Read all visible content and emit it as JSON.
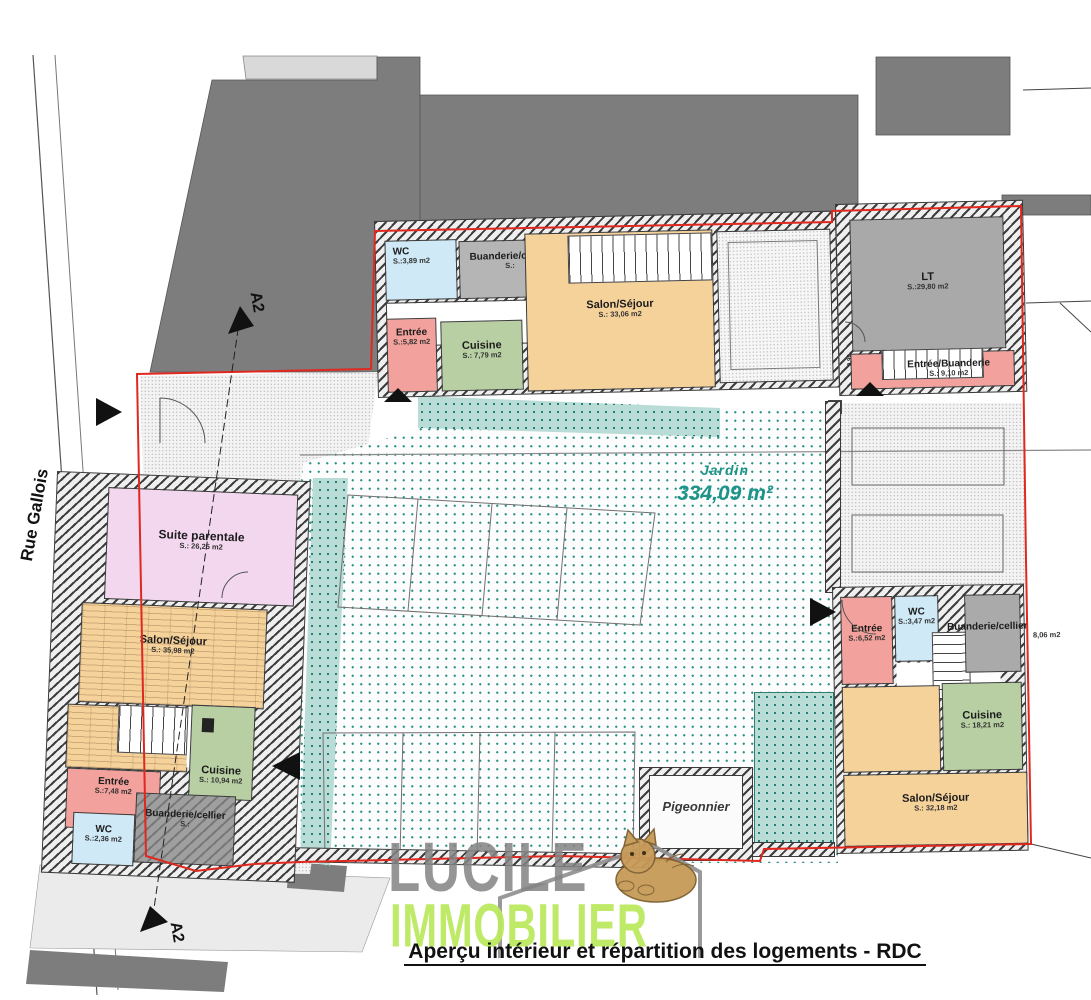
{
  "caption": "Aperçu intérieur et répartition des logements - RDC",
  "street_label": "Rue Gallois",
  "section_marks": {
    "top": "A2",
    "bottom": "A2"
  },
  "garden": {
    "label": "Jardin",
    "area": "334,09 m²"
  },
  "watermark": {
    "line1": "LUCILE",
    "line2": "IMMOBILIER"
  },
  "dimension_small": "0,90",
  "colors": {
    "boundary_red": "#e0281e",
    "garden_teal": "#1d9489",
    "watermark_green": "#bce95f",
    "watermark_gray": "#8e8e8e",
    "entree_pink": "#f2a19c",
    "wc_blue": "#cfe9f6",
    "cuisine_green": "#b7cfa2",
    "salon_orange": "#f6d29b",
    "suite_pink": "#f3d7ef",
    "buanderie_gray": "#b0b0b0"
  },
  "rooms": {
    "u1_wc": {
      "name": "WC",
      "area": "S.:3,89 m2"
    },
    "u1_buanderie": {
      "name": "Buanderie/cellier",
      "area": "S.:"
    },
    "u1_entree": {
      "name": "Entrée",
      "area": "S.:5,82 m2"
    },
    "u1_cuisine": {
      "name": "Cuisine",
      "area": "S.: 7,79 m2"
    },
    "u1_salon": {
      "name": "Salon/Séjour",
      "area": "S.:   33,06 m2"
    },
    "u2_lt": {
      "name": "LT",
      "area": "S.:29,80 m2"
    },
    "u2_entree_buanderie": {
      "name": "Entrée/Buanderie",
      "area": "S.:   9,10 m2"
    },
    "u3_suite": {
      "name": "Suite parentale",
      "area": "S.:   26,25 m2"
    },
    "u3_salon": {
      "name": "Salon/Séjour",
      "area": "S.:   35,98 m2"
    },
    "u3_cuisine": {
      "name": "Cuisine",
      "area": "S.: 10,94 m2"
    },
    "u3_entree": {
      "name": "Entrée",
      "area": "S.:7,48 m2"
    },
    "u3_buanderie": {
      "name": "Buanderie/cellier",
      "area": "S.:"
    },
    "u3_wc": {
      "name": "WC",
      "area": "S.:2,36 m2"
    },
    "u4_entree": {
      "name": "Entrée",
      "area": "S.:6,52 m2"
    },
    "u4_wc": {
      "name": "WC",
      "area": "S.:3,47 m2"
    },
    "u4_buanderie": {
      "name": "Buanderie/cellier",
      "area": "8,06 m2"
    },
    "u4_cuisine": {
      "name": "Cuisine",
      "area": "S.: 18,21 m2"
    },
    "u4_salon": {
      "name": "Salon/Séjour",
      "area": "S.:   32,18 m2"
    },
    "pigeonnier": {
      "name": "Pigeonnier",
      "area": ""
    }
  }
}
